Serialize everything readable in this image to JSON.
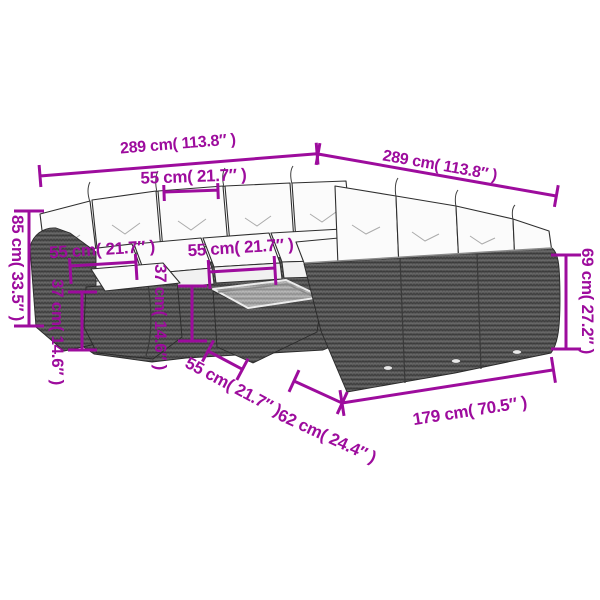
{
  "diagram": {
    "title": "Rattan garden corner sofa set dimension diagram",
    "dimensions": {
      "total_width_left": "289 cm( 113.8″ )",
      "total_width_right": "289 cm( 113.8″ )",
      "seat_width_top": "55 cm( 21.7″ )",
      "seat_width_mid_left": "55 cm( 21.7″ )",
      "seat_width_mid_right": "55 cm( 21.7″ )",
      "ottoman_width": "55 cm( 21.7″ )",
      "total_height": "85 cm( 33.5″ )",
      "seat_height_left": "37 cm( 14.6″ )",
      "seat_height_center": "37 cm( 14.6″ )",
      "back_height": "69 cm( 27.2″ )",
      "table_width": "62 cm( 24.4″ )",
      "sofa_depth": "179 cm( 70.5″ )"
    },
    "colors": {
      "annotation": "#9D0C9D",
      "rattan_dark": "#565656",
      "rattan_light": "#A5A5A5",
      "cushion": "#FBFBFB",
      "background": "#FFFFFF"
    }
  }
}
